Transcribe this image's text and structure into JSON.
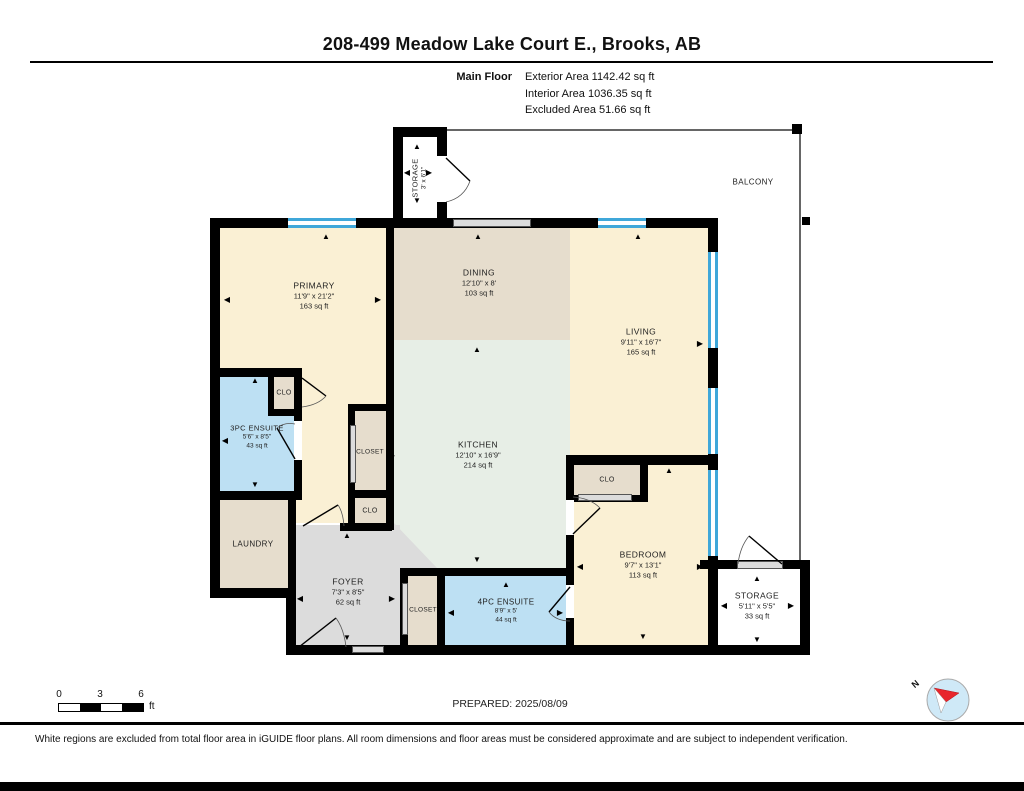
{
  "header": {
    "title": "208-499 Meadow Lake Court E., Brooks, AB",
    "floor_label": "Main Floor",
    "stats": [
      "Exterior Area 1142.42 sq ft",
      "Interior Area 1036.35 sq ft",
      "Excluded Area 51.66 sq ft"
    ]
  },
  "rooms": {
    "storage_top": {
      "name": "STORAGE",
      "dims": "3' x 6'1\""
    },
    "balcony": {
      "name": "BALCONY"
    },
    "primary": {
      "name": "PRIMARY",
      "dims": "11'9\" x 21'2\"",
      "area": "163 sq ft"
    },
    "dining": {
      "name": "DINING",
      "dims": "12'10\" x 8'",
      "area": "103 sq ft"
    },
    "living": {
      "name": "LIVING",
      "dims": "9'11\" x 16'7\"",
      "area": "165 sq ft"
    },
    "kitchen": {
      "name": "KITCHEN",
      "dims": "12'10\" x 16'9\"",
      "area": "214 sq ft"
    },
    "ensuite3": {
      "name": "3PC ENSUITE",
      "dims": "5'6\" x 8'5\"",
      "area": "43 sq ft"
    },
    "clo_primary": {
      "name": "CLO"
    },
    "closet_primary": {
      "name": "CLOSET"
    },
    "clo_hall": {
      "name": "CLO"
    },
    "laundry": {
      "name": "LAUNDRY"
    },
    "foyer": {
      "name": "FOYER",
      "dims": "7'3\" x 8'5\"",
      "area": "62 sq ft"
    },
    "closet_foyer": {
      "name": "CLOSET"
    },
    "ensuite4": {
      "name": "4PC ENSUITE",
      "dims": "8'9\" x 5'",
      "area": "44 sq ft"
    },
    "bedroom": {
      "name": "BEDROOM",
      "dims": "9'7\" x 13'1\"",
      "area": "113 sq ft"
    },
    "clo_bedroom": {
      "name": "CLO"
    },
    "storage_br": {
      "name": "STORAGE",
      "dims": "5'11\" x 5'5\"",
      "area": "33 sq ft"
    }
  },
  "icons": {
    "up": "▲",
    "down": "▼",
    "left": "◀",
    "right": "▶"
  },
  "footer": {
    "scale": {
      "tick0": "0",
      "tick1": "3",
      "tick2": "6",
      "unit": "ft"
    },
    "prepared": "PREPARED: 2025/08/09",
    "compass": "N",
    "disclaimer": "White regions are excluded from total floor area in iGUIDE floor plans. All room dimensions and floor areas must be considered approximate and are subject to independent verification."
  },
  "colors": {
    "room_cream": "#faf0d4",
    "room_tan": "#e6ddcd",
    "room_green": "#e7eee6",
    "room_blue": "#bde0f3",
    "room_gray": "#dcdcdc",
    "window_blue": "#3fa7d9",
    "wall": "#000000",
    "compass_blue": "#cfe9f7",
    "compass_red": "#e8262c"
  }
}
